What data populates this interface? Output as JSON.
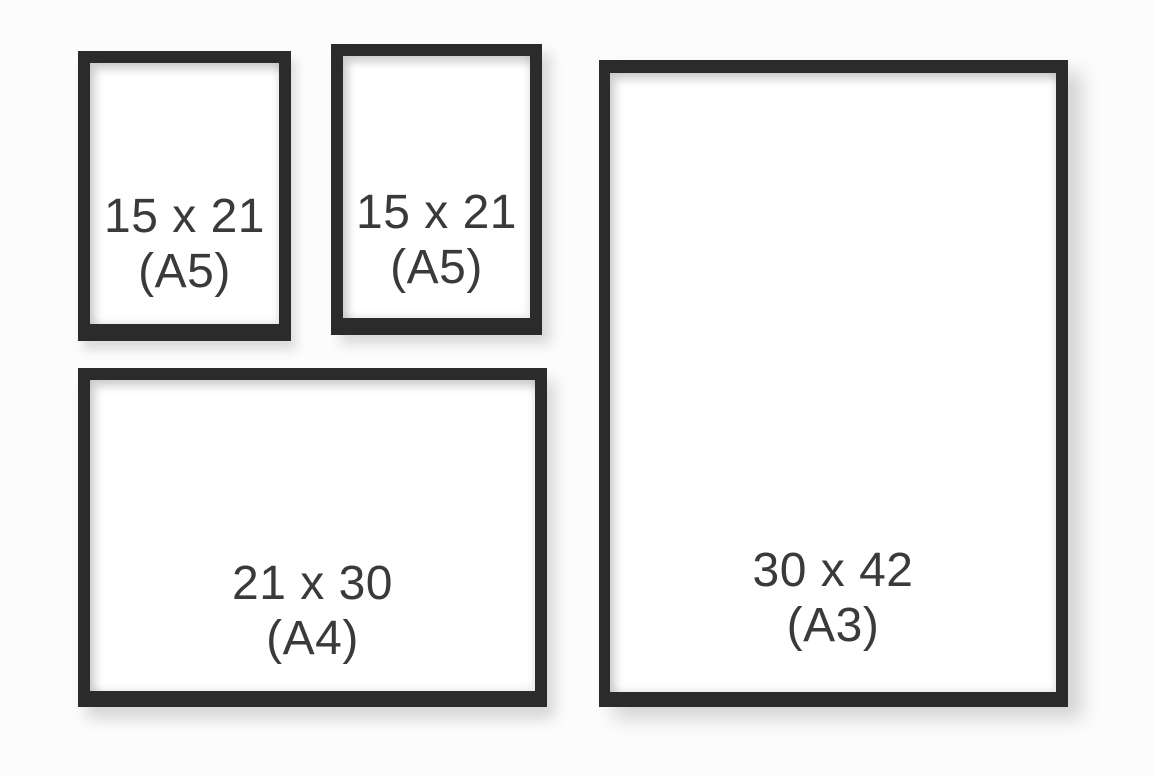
{
  "colors": {
    "background": "#fcfcfc",
    "frame": "#2b2b2b",
    "mat": "#ffffff",
    "label": "#3a3a3a"
  },
  "frames": [
    {
      "id": "a5-top-left",
      "size_label": "15 x 21",
      "format_label": "(A5)"
    },
    {
      "id": "a5-top-middle",
      "size_label": "15 x 21",
      "format_label": "(A5)"
    },
    {
      "id": "a3-right",
      "size_label": "30 x 42",
      "format_label": "(A3)"
    },
    {
      "id": "a4-bottom-left",
      "size_label": "21 x 30",
      "format_label": "(A4)"
    }
  ]
}
